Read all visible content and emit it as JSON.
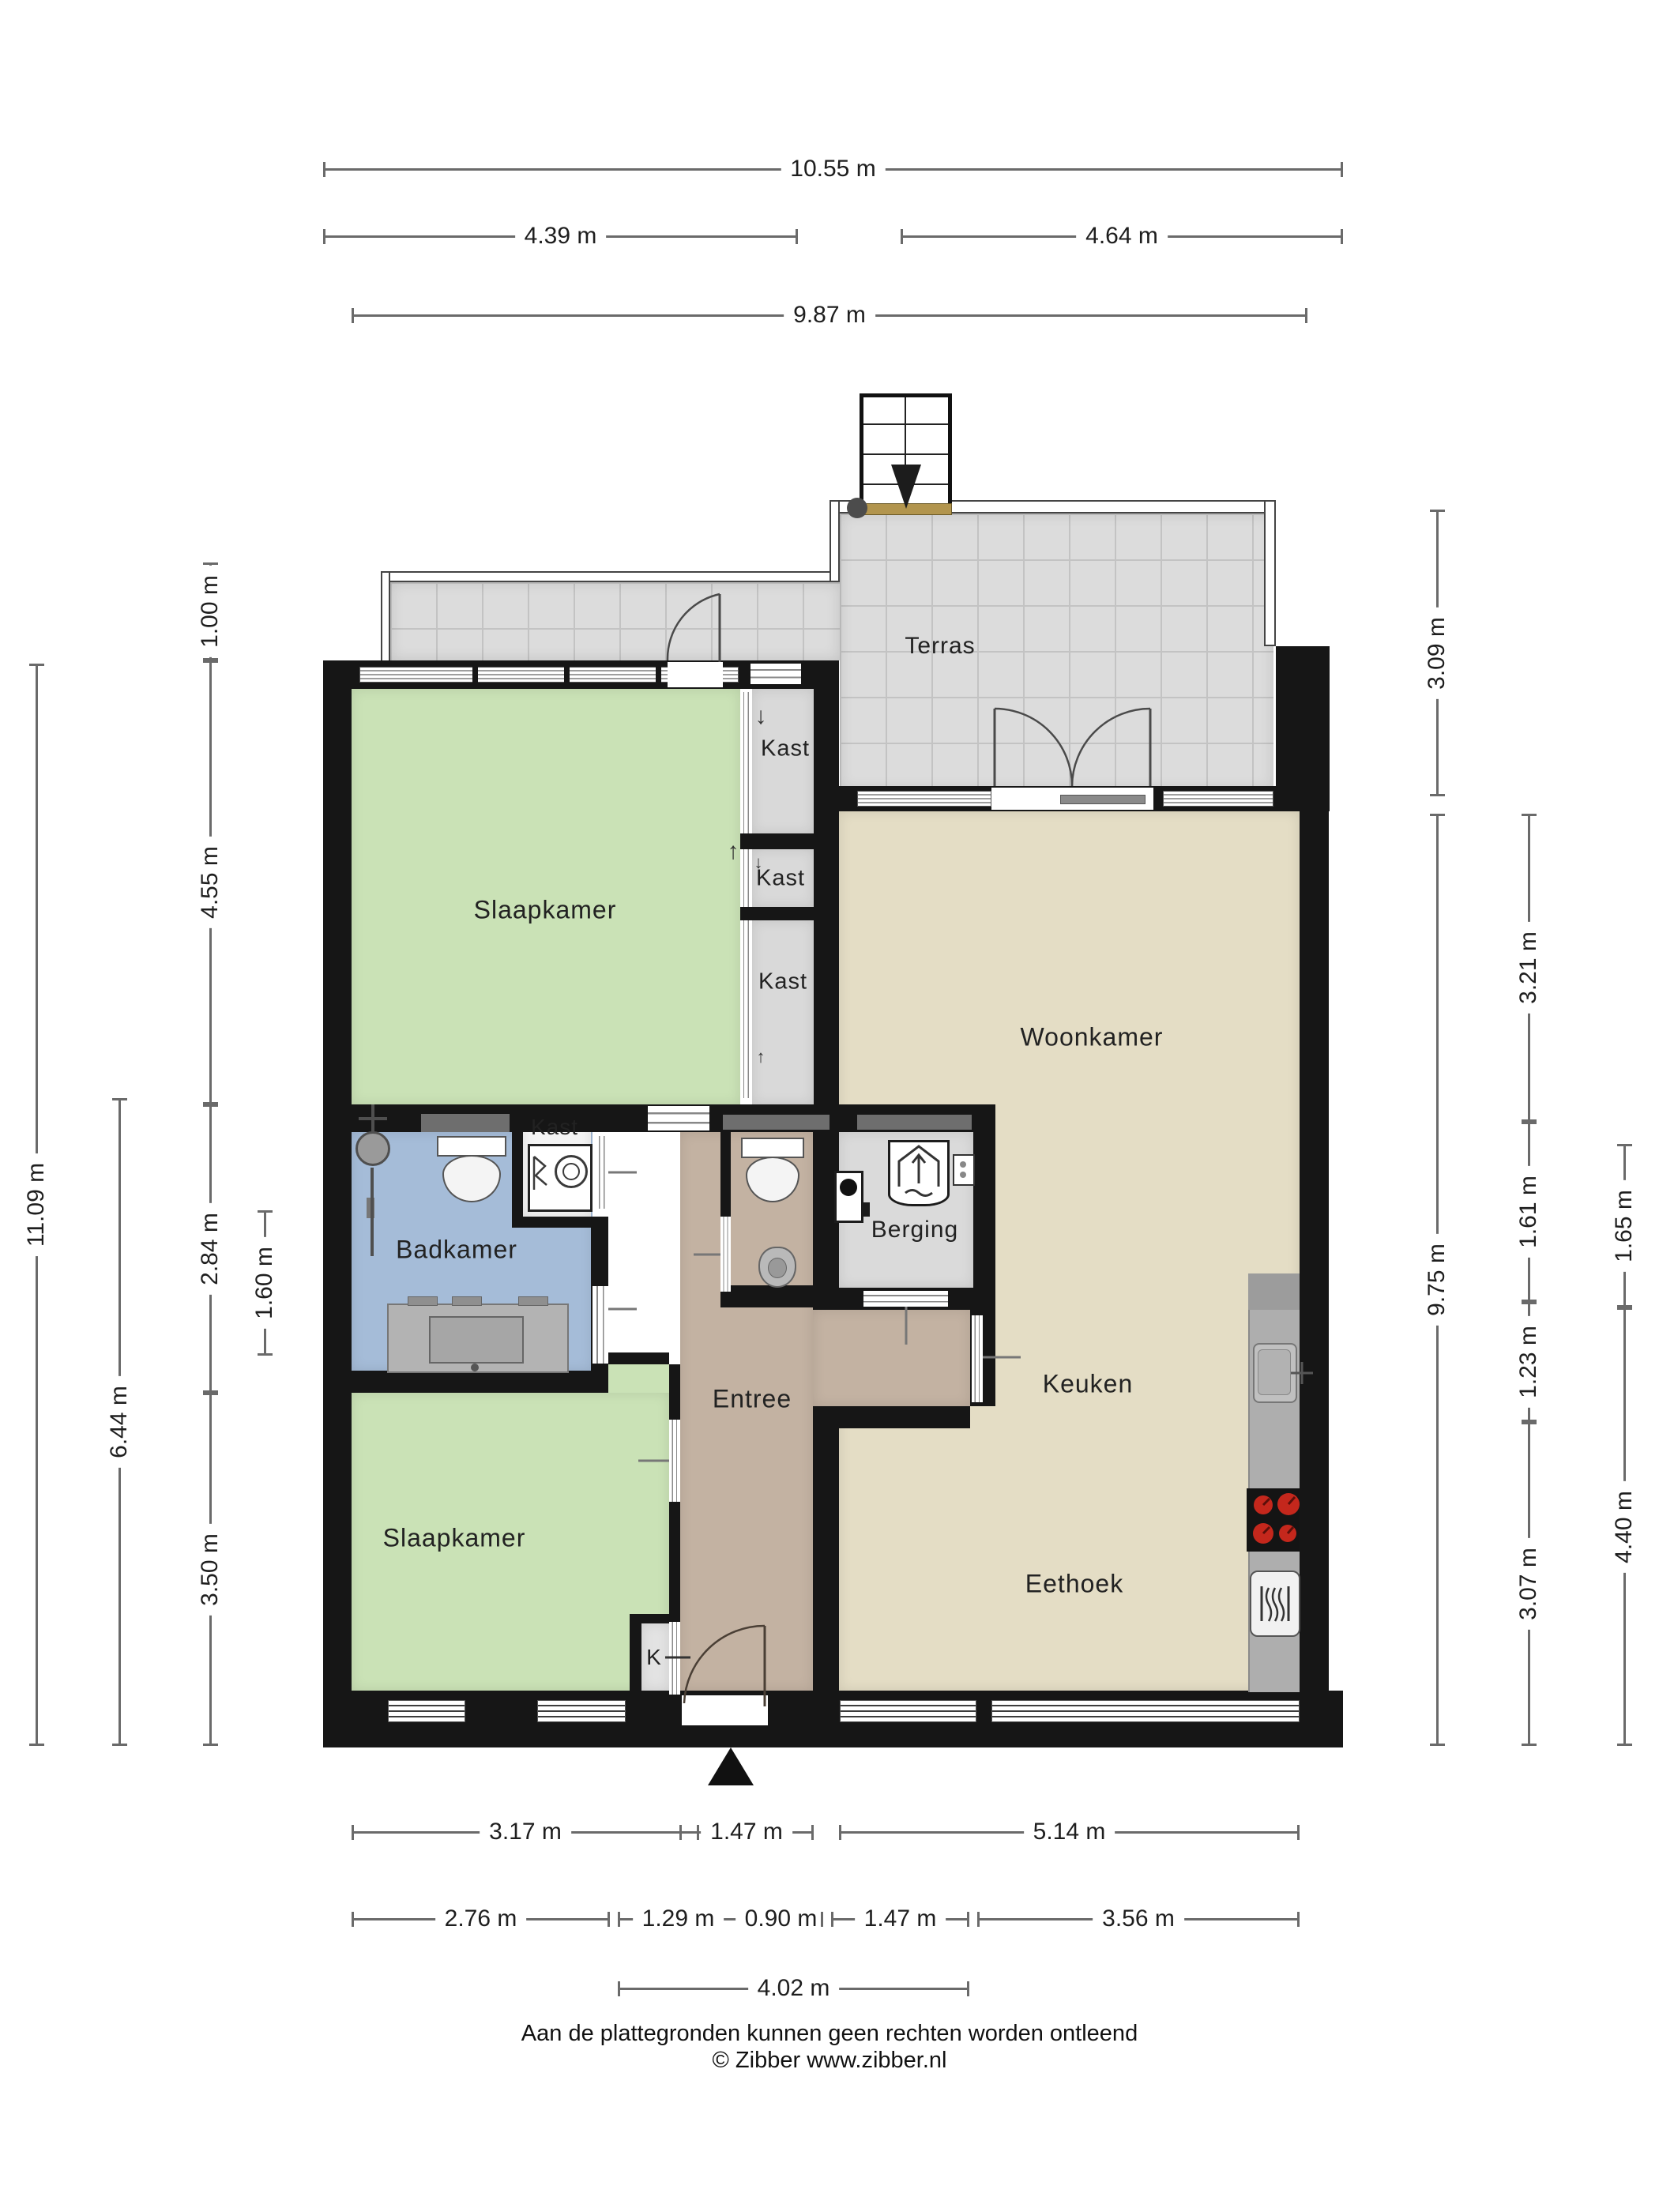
{
  "plan": {
    "type": "floor-plan",
    "source_footer": {
      "line1": "Aan de plattegronden kunnen geen rechten worden ontleend",
      "line2": "© Zibber www.zibber.nl"
    }
  },
  "rooms": [
    {
      "id": "terras",
      "label": "Terras"
    },
    {
      "id": "slaapkamer-1",
      "label": "Slaapkamer"
    },
    {
      "id": "kast-1",
      "label": "Kast"
    },
    {
      "id": "kast-2",
      "label": "Kast"
    },
    {
      "id": "kast-3",
      "label": "Kast"
    },
    {
      "id": "woonkamer",
      "label": "Woonkamer"
    },
    {
      "id": "badkamer",
      "label": "Badkamer"
    },
    {
      "id": "kast-4",
      "label": "Kast"
    },
    {
      "id": "berging",
      "label": "Berging"
    },
    {
      "id": "entree",
      "label": "Entree"
    },
    {
      "id": "keuken",
      "label": "Keuken"
    },
    {
      "id": "slaapkamer-2",
      "label": "Slaapkamer"
    },
    {
      "id": "eethoek",
      "label": "Eethoek"
    },
    {
      "id": "k-closet",
      "label": "K"
    }
  ],
  "icons": {
    "arrow_up": "↑",
    "arrow_down": "↓"
  },
  "dimensions": {
    "top": [
      {
        "label": "10.55 m"
      },
      {
        "label": "4.39 m"
      },
      {
        "label": "4.64 m"
      },
      {
        "label": "9.87 m"
      }
    ],
    "left": [
      {
        "label": "11.09 m"
      },
      {
        "label": "6.44 m"
      },
      {
        "label": "1.00 m"
      },
      {
        "label": "4.55 m"
      },
      {
        "label": "2.84 m"
      },
      {
        "label": "3.50 m"
      },
      {
        "label": "1.60 m"
      }
    ],
    "right": [
      {
        "label": "3.09 m"
      },
      {
        "label": "9.75 m"
      },
      {
        "label": "3.21 m"
      },
      {
        "label": "1.61 m"
      },
      {
        "label": "1.23 m"
      },
      {
        "label": "3.07 m"
      },
      {
        "label": "1.65 m"
      },
      {
        "label": "4.40 m"
      }
    ],
    "bottom": [
      {
        "label": "3.17 m"
      },
      {
        "label": "1.47 m"
      },
      {
        "label": "5.14 m"
      },
      {
        "label": "2.76 m"
      },
      {
        "label": "1.29 m"
      },
      {
        "label": "0.90 m"
      },
      {
        "label": "1.47 m"
      },
      {
        "label": "3.56 m"
      },
      {
        "label": "4.02 m"
      }
    ]
  },
  "colors": {
    "wall": "#161616",
    "bedroom_green": "#cae2b6",
    "living_beige": "#e4ddc5",
    "bath_blue": "#a5bcd8",
    "hall_tan": "#c3b2a2",
    "storage_gray": "#dadada",
    "terrace_gray": "#dcdcdc",
    "threshold_gold": "#b2954e",
    "burner_red": "#c4271c"
  }
}
